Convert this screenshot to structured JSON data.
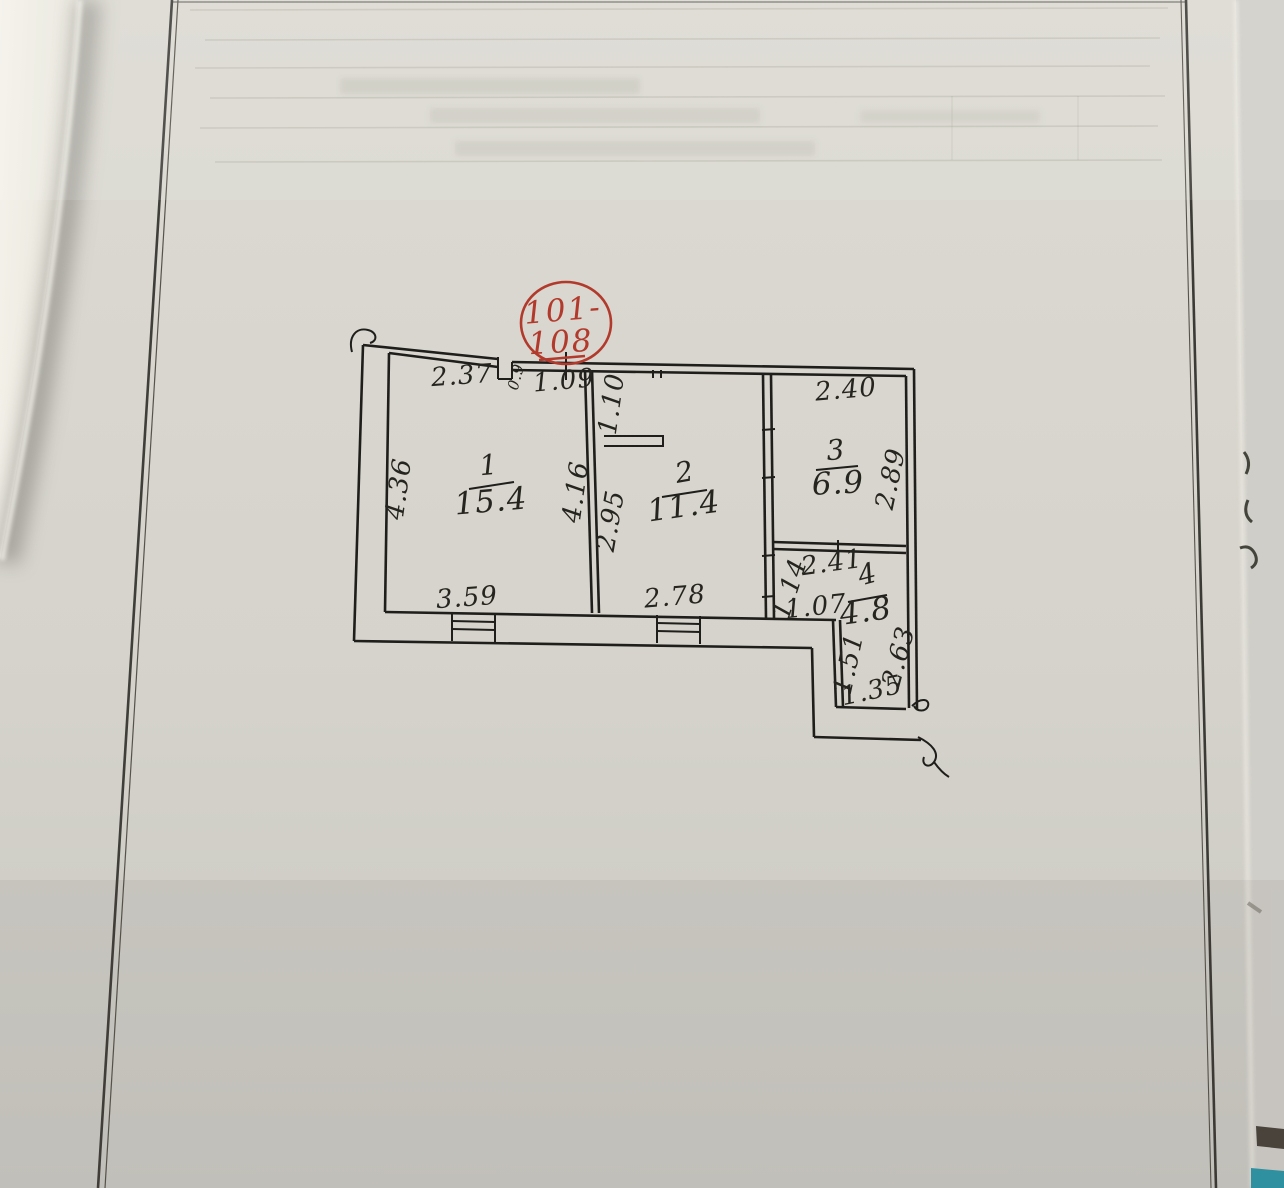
{
  "document": {
    "kind": "scanned floor plan sheet",
    "stamp": {
      "line1": "101-",
      "line2": "108"
    },
    "rooms": [
      {
        "number": "1",
        "area": "15.4"
      },
      {
        "number": "2",
        "area": "11.4"
      },
      {
        "number": "3",
        "area": "6.9"
      },
      {
        "number": "4",
        "area": "4.8"
      }
    ],
    "dimensions": {
      "room1_top": "2.37",
      "door": "0.9",
      "entry_top": "1.09",
      "entry_side": "1.10",
      "room1_left": "4.36",
      "room1_right": "4.16",
      "room2_left": "2.95",
      "room3_top": "2.40",
      "room3_right": "2.89",
      "room1_bottom": "3.59",
      "room2_bottom": "2.78",
      "room4_top": "2.41",
      "hall_diag": "1.14",
      "hall_bottom": "1.07",
      "bath_left": "1.51",
      "bath_bottom": "1.35",
      "bath_right": "2.63"
    },
    "colors": {
      "paper": "#d6d4cc",
      "ink": "#1f1e1b",
      "stamp_red": "#b23a2c",
      "teal_mark": "#2e96a7",
      "dark_mark": "#4a443c"
    }
  }
}
